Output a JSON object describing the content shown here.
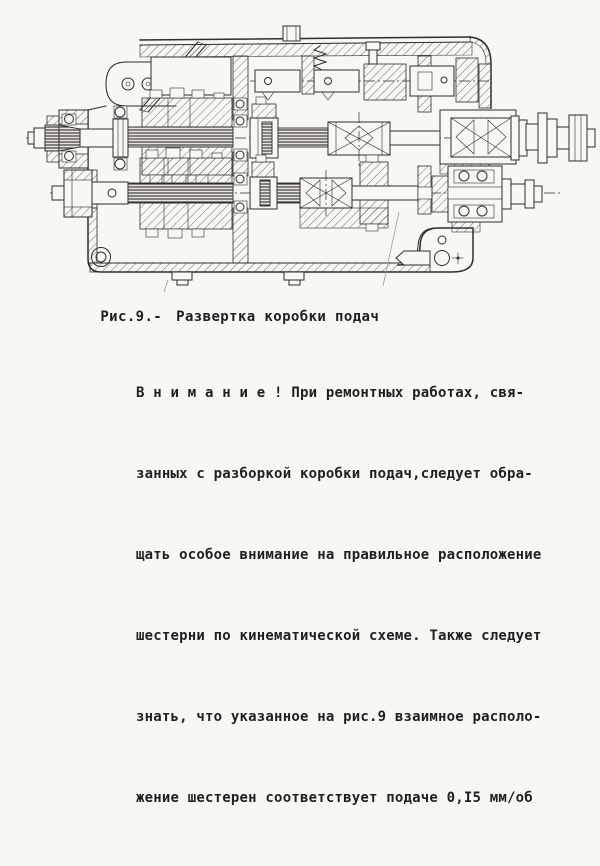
{
  "figure": {
    "label": "Рис.9.-",
    "title": "Развертка коробки подач"
  },
  "note": {
    "lines": [
      "В н и м а н и е ! При ремонтных работах, свя-",
      "занных с разборкой коробки подач,следует обра-",
      "щать особое внимание на правильное расположение",
      "шестерни по кинематической схеме. Также следует",
      "знать, что указанное на рис.9 взаимное располо-",
      "жение шестерен соответствует подаче 0,I5 мм/об"
    ]
  },
  "colors": {
    "paper": "#f8f7f4",
    "ink": "#1f1f1f",
    "line": "#2e2e2e"
  }
}
